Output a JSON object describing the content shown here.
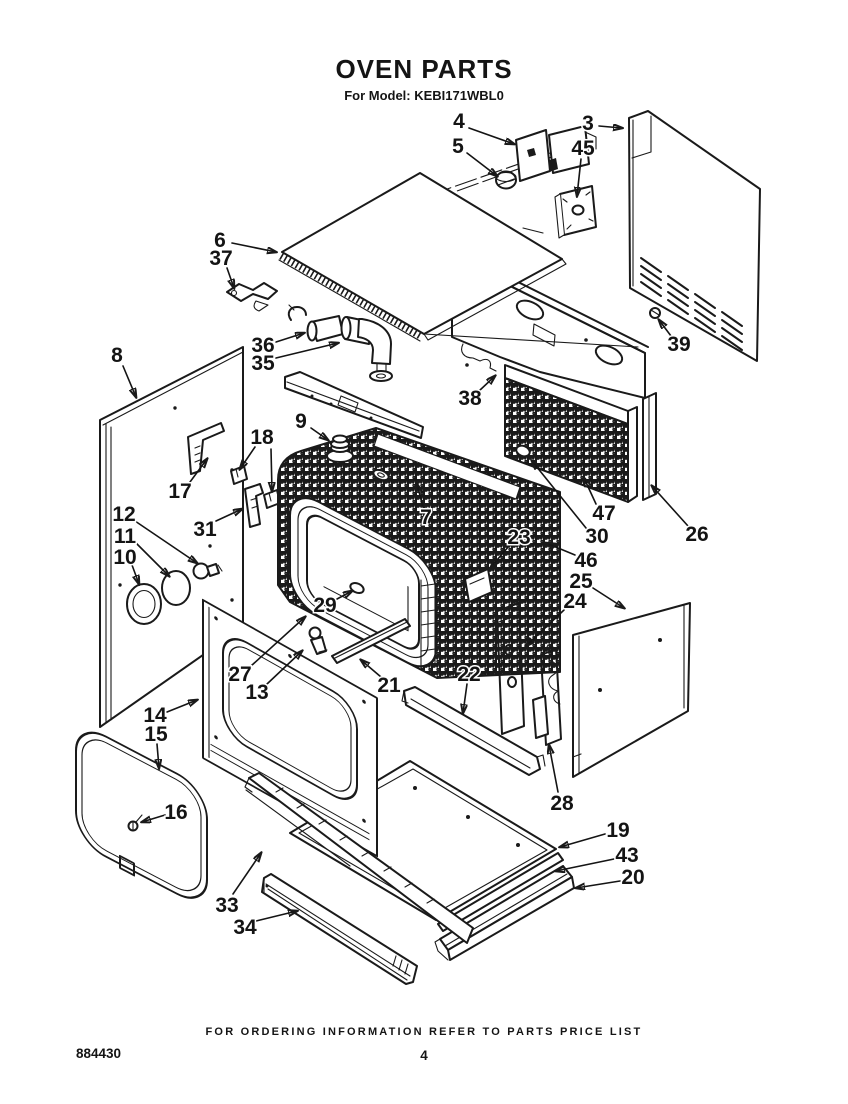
{
  "page": {
    "title": "OVEN PARTS",
    "subtitle": "For Model: KEBI171WBL0",
    "footer_note": "FOR ORDERING INFORMATION REFER TO PARTS PRICE LIST",
    "doc_number": "884430",
    "page_number": "4"
  },
  "diagram": {
    "ink_color": "#1a1a1a",
    "paper_color": "#ffffff",
    "callouts": [
      {
        "n": "4",
        "x": 459,
        "y": 121,
        "arrows": [
          [
            469,
            128,
            514,
            144
          ]
        ]
      },
      {
        "n": "5",
        "x": 458,
        "y": 146,
        "arrows": [
          [
            467,
            153,
            497,
            176
          ]
        ]
      },
      {
        "n": "45",
        "x": 583,
        "y": 148,
        "arrows": [
          [
            581,
            159,
            577,
            196
          ]
        ]
      },
      {
        "n": "3",
        "x": 588,
        "y": 123,
        "arrows": [
          [
            599,
            126,
            622,
            128
          ]
        ]
      },
      {
        "n": "39",
        "x": 679,
        "y": 344,
        "arrows": [
          [
            671,
            336,
            659,
            320
          ]
        ]
      },
      {
        "n": "6",
        "x": 220,
        "y": 240,
        "arrows": [
          [
            232,
            243,
            276,
            252
          ]
        ]
      },
      {
        "n": "37",
        "x": 221,
        "y": 258,
        "arrows": [
          [
            227,
            268,
            234,
            288
          ]
        ]
      },
      {
        "n": "36",
        "x": 263,
        "y": 345,
        "arrows": [
          [
            276,
            342,
            304,
            333
          ]
        ]
      },
      {
        "n": "35",
        "x": 263,
        "y": 363,
        "arrows": [
          [
            276,
            358,
            338,
            343
          ]
        ]
      },
      {
        "n": "38",
        "x": 470,
        "y": 398,
        "arrows": [
          [
            479,
            391,
            495,
            376
          ]
        ]
      },
      {
        "n": "9",
        "x": 301,
        "y": 421,
        "arrows": [
          [
            311,
            428,
            328,
            440
          ]
        ]
      },
      {
        "n": "8",
        "x": 117,
        "y": 355,
        "arrows": [
          [
            123,
            366,
            136,
            397
          ]
        ]
      },
      {
        "n": "17",
        "x": 180,
        "y": 491,
        "arrows": [
          [
            190,
            482,
            207,
            459
          ]
        ]
      },
      {
        "n": "18",
        "x": 262,
        "y": 437,
        "arrows": [
          [
            255,
            447,
            240,
            469
          ],
          [
            271,
            449,
            272,
            491
          ]
        ]
      },
      {
        "n": "31",
        "x": 205,
        "y": 529,
        "arrows": [
          [
            216,
            521,
            242,
            509
          ]
        ]
      },
      {
        "n": "12",
        "x": 124,
        "y": 514,
        "arrows": [
          [
            135,
            521,
            197,
            563
          ]
        ]
      },
      {
        "n": "11",
        "x": 125,
        "y": 536,
        "arrows": [
          [
            136,
            543,
            169,
            576
          ]
        ]
      },
      {
        "n": "10",
        "x": 125,
        "y": 557,
        "arrows": [
          [
            132,
            565,
            139,
            584
          ]
        ]
      },
      {
        "n": "7",
        "x": 426,
        "y": 517,
        "arrows": [
          [
            423,
            507,
            417,
            484
          ]
        ]
      },
      {
        "n": "23",
        "x": 519,
        "y": 537,
        "arrows": [
          [
            509,
            546,
            491,
            567
          ]
        ]
      },
      {
        "n": "47",
        "x": 604,
        "y": 513,
        "arrows": [
          [
            596,
            504,
            584,
            478
          ]
        ]
      },
      {
        "n": "30",
        "x": 597,
        "y": 536,
        "arrows": [
          [
            586,
            528,
            532,
            461
          ]
        ]
      },
      {
        "n": "46",
        "x": 586,
        "y": 560,
        "arrows": [
          [
            575,
            555,
            546,
            543
          ]
        ]
      },
      {
        "n": "26",
        "x": 697,
        "y": 534,
        "arrows": [
          [
            688,
            526,
            652,
            486
          ]
        ]
      },
      {
        "n": "25",
        "x": 581,
        "y": 581,
        "arrows": [
          [
            593,
            588,
            624,
            608
          ]
        ]
      },
      {
        "n": "24",
        "x": 575,
        "y": 601,
        "arrows": [
          [
            564,
            610,
            526,
            646
          ]
        ]
      },
      {
        "n": "29",
        "x": 325,
        "y": 605,
        "arrows": [
          [
            337,
            599,
            352,
            591
          ]
        ]
      },
      {
        "n": "27",
        "x": 240,
        "y": 674,
        "arrows": [
          [
            251,
            666,
            305,
            617
          ]
        ]
      },
      {
        "n": "13",
        "x": 257,
        "y": 692,
        "arrows": [
          [
            267,
            684,
            302,
            651
          ]
        ]
      },
      {
        "n": "21",
        "x": 389,
        "y": 685,
        "arrows": [
          [
            381,
            677,
            361,
            660
          ]
        ]
      },
      {
        "n": "22",
        "x": 469,
        "y": 674,
        "arrows": [
          [
            467,
            684,
            463,
            713
          ]
        ]
      },
      {
        "n": "28",
        "x": 562,
        "y": 803,
        "arrows": [
          [
            558,
            792,
            549,
            745
          ]
        ]
      },
      {
        "n": "14",
        "x": 155,
        "y": 715,
        "arrows": [
          [
            167,
            712,
            197,
            700
          ]
        ]
      },
      {
        "n": "15",
        "x": 156,
        "y": 734,
        "arrows": [
          [
            157,
            744,
            159,
            768
          ]
        ]
      },
      {
        "n": "16",
        "x": 176,
        "y": 812,
        "arrows": [
          [
            165,
            815,
            142,
            822
          ]
        ]
      },
      {
        "n": "19",
        "x": 618,
        "y": 830,
        "arrows": [
          [
            605,
            834,
            560,
            847
          ]
        ]
      },
      {
        "n": "43",
        "x": 627,
        "y": 855,
        "arrows": [
          [
            614,
            859,
            556,
            871
          ]
        ]
      },
      {
        "n": "20",
        "x": 633,
        "y": 877,
        "arrows": [
          [
            620,
            881,
            576,
            888
          ]
        ]
      },
      {
        "n": "33",
        "x": 227,
        "y": 905,
        "arrows": [
          [
            233,
            894,
            261,
            853
          ]
        ]
      },
      {
        "n": "34",
        "x": 245,
        "y": 927,
        "arrows": [
          [
            256,
            921,
            297,
            911
          ]
        ]
      }
    ]
  }
}
